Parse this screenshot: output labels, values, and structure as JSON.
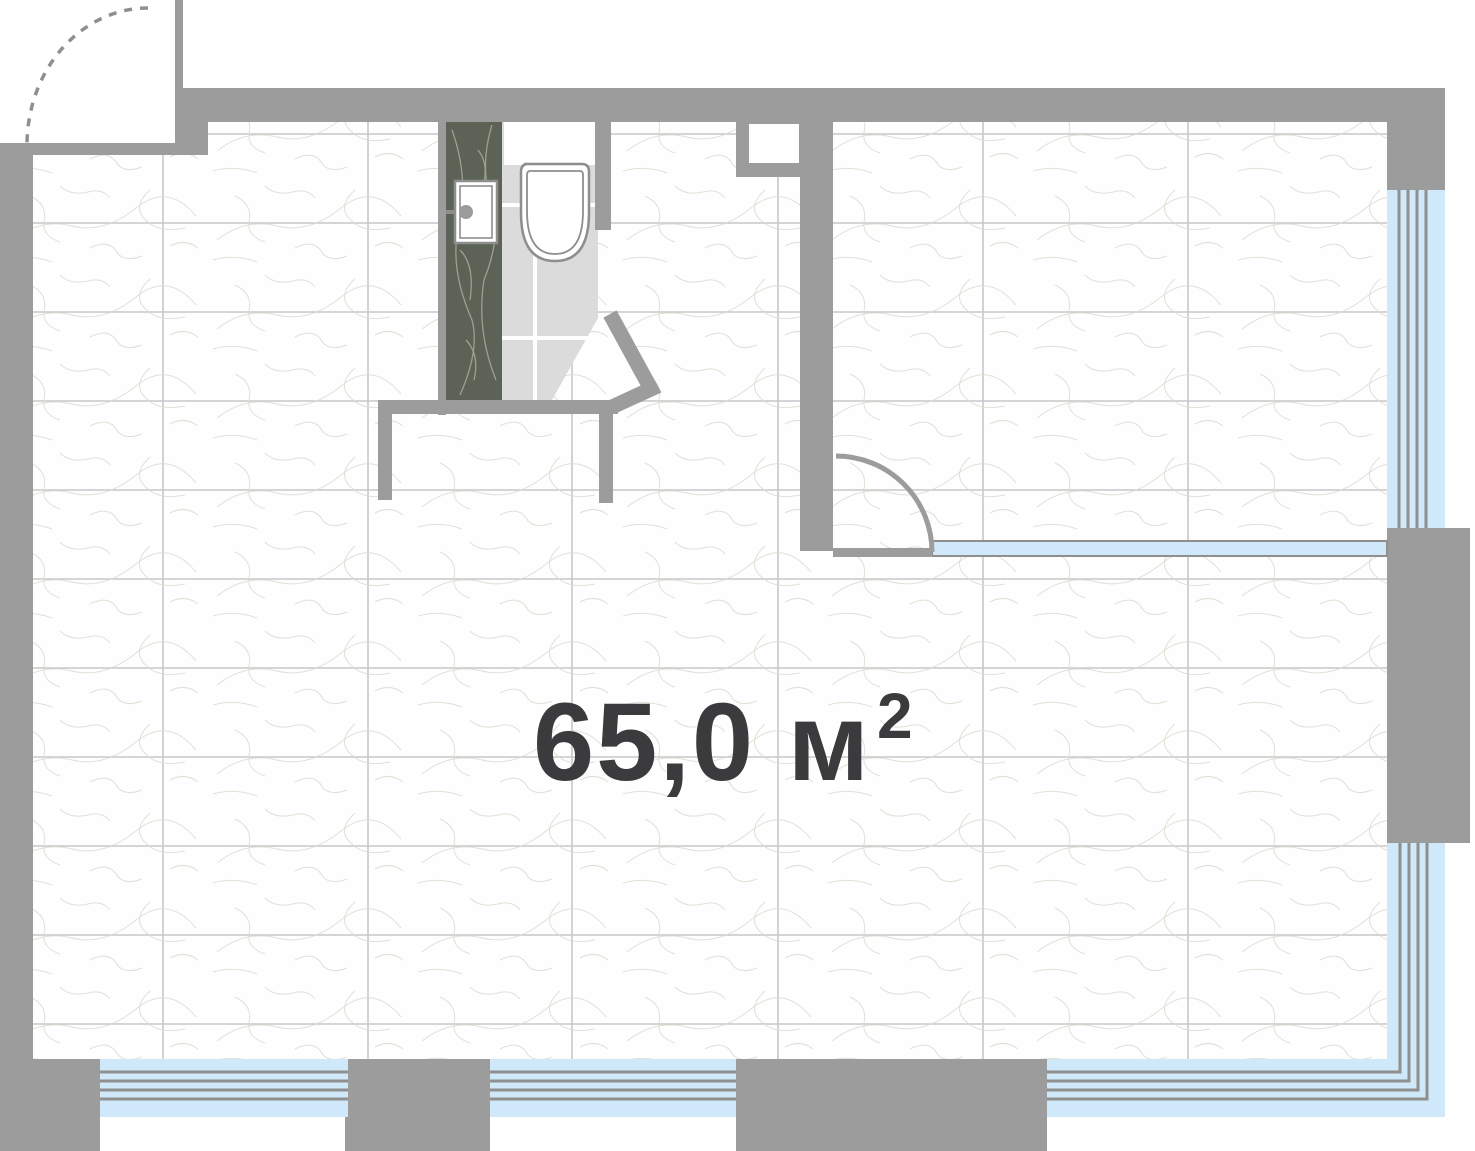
{
  "plan": {
    "area_label": {
      "value": "65,0 м",
      "superscript": "2",
      "full": "65,0 м²"
    },
    "colors": {
      "wall": "#9c9c9c",
      "floor": "#fefefe",
      "grout": "#c7c7c7",
      "vein": "#e0d9cf",
      "tile": "#dbdbdb",
      "tile_grout": "#ffffff",
      "marble": "#5d6257",
      "marble_vein": "#99a28f",
      "glass": "#cfe8fa",
      "frame": "#8f8f8f",
      "fixture": "#8e8e8e",
      "text": "#3b3b3d"
    },
    "icons": {
      "entrance_door": "door-swing-arc",
      "room_door": "door-swing-arc",
      "toilet": "toilet-top-view",
      "sink": "sink-top-view",
      "partition": "glass-partition",
      "window": "multi-pane-window"
    }
  }
}
